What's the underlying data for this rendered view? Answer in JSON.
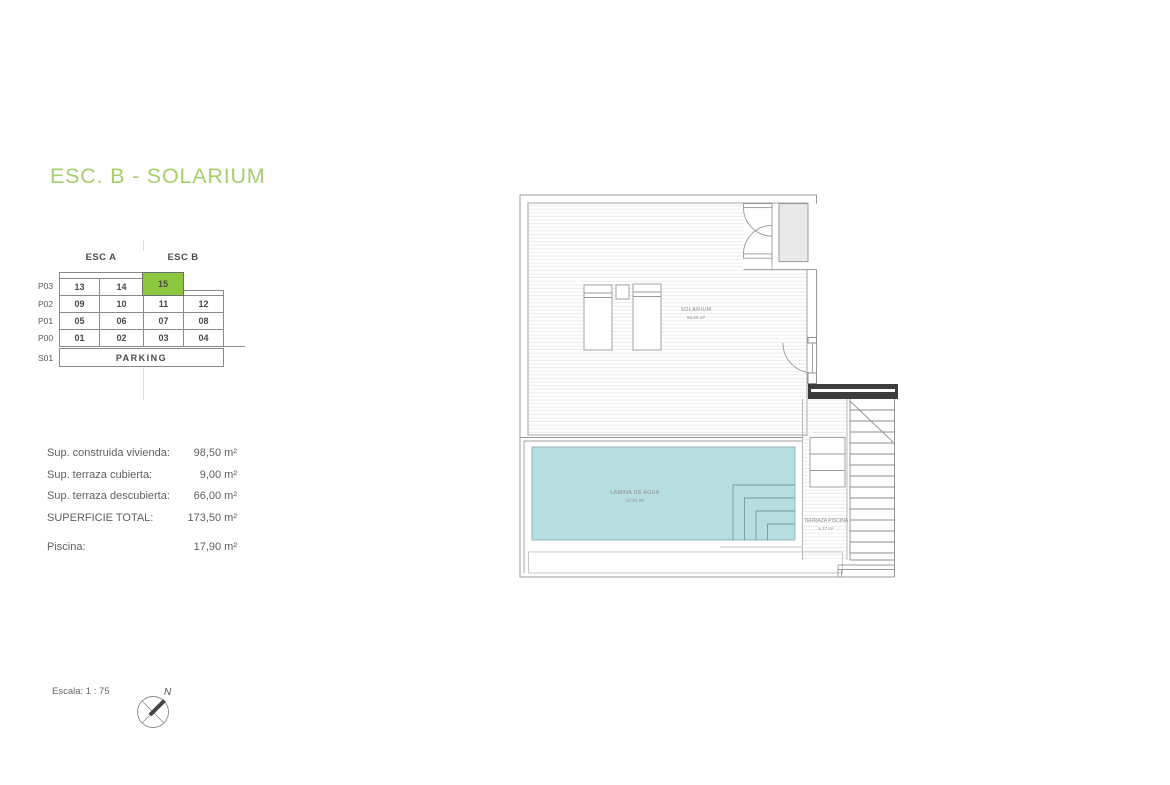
{
  "title": "ESC. B - SOLARIUM",
  "units_table": {
    "col_headers": [
      "ESC A",
      "ESC B"
    ],
    "row_labels": [
      "P03",
      "P02",
      "P01",
      "P00",
      "S01"
    ],
    "rows": [
      {
        "label": "P03",
        "cells": [
          "13",
          "14",
          "15"
        ],
        "highlighted_cell": "15"
      },
      {
        "label": "P02",
        "cells": [
          "09",
          "10",
          "11",
          "12"
        ]
      },
      {
        "label": "P01",
        "cells": [
          "05",
          "06",
          "07",
          "08"
        ]
      },
      {
        "label": "P00",
        "cells": [
          "01",
          "02",
          "03",
          "04"
        ]
      },
      {
        "label": "S01",
        "cells": [
          "PARKING"
        ]
      }
    ]
  },
  "surfaces": {
    "rows": [
      {
        "label": "Sup. construida vivienda:",
        "value": "98,50 m²"
      },
      {
        "label": "Sup. terraza cubierta:",
        "value": "9,00 m²"
      },
      {
        "label": "Sup. terraza descubierta:",
        "value": "66,00 m²"
      },
      {
        "label": "SUPERFICIE TOTAL:",
        "value": "173,50 m²"
      },
      {
        "label": "Piscina:",
        "value": "17,90 m²"
      }
    ]
  },
  "plan": {
    "solarium_label": "SOLARIUM",
    "solarium_area": "66,00 m²",
    "pool_label": "LAMINA DE AGUA",
    "pool_area": "17,91 m²",
    "terrace_label": "TERRAZA PISCINA",
    "terrace_area": "6,17 m²"
  },
  "footer": {
    "scale_label": "Escala: 1 : 75",
    "north_label": "N"
  },
  "colors": {
    "accent_green": "#a6ce6d",
    "highlight_green": "#8dc63f",
    "pool_teal": "#b6dde0"
  }
}
